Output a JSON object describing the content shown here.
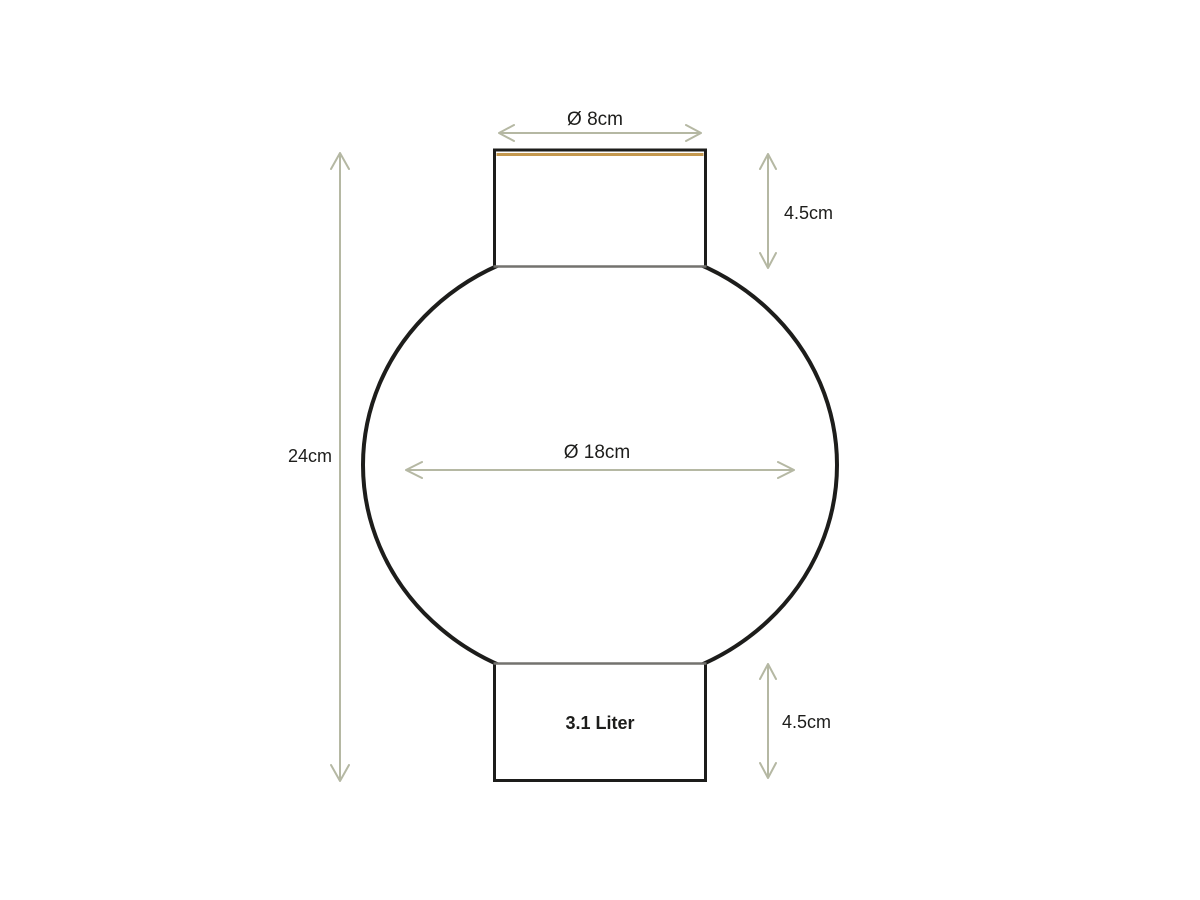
{
  "diagram": {
    "type": "product-dimension-drawing",
    "subject": "round vase with cylindrical neck and base",
    "labels": {
      "top_diameter": "Ø 8cm",
      "neck_height": "4.5cm",
      "total_height": "24cm",
      "body_diameter": "Ø 18cm",
      "base_height": "4.5cm",
      "volume": "3.1 Liter"
    },
    "colors": {
      "outline": "#1d1d1b",
      "inner_edge": "#73726e",
      "rim_accent": "#c4984e",
      "dimension": "#b5b8a3",
      "label_text": "#1d1d1b",
      "background": "#ffffff"
    }
  }
}
